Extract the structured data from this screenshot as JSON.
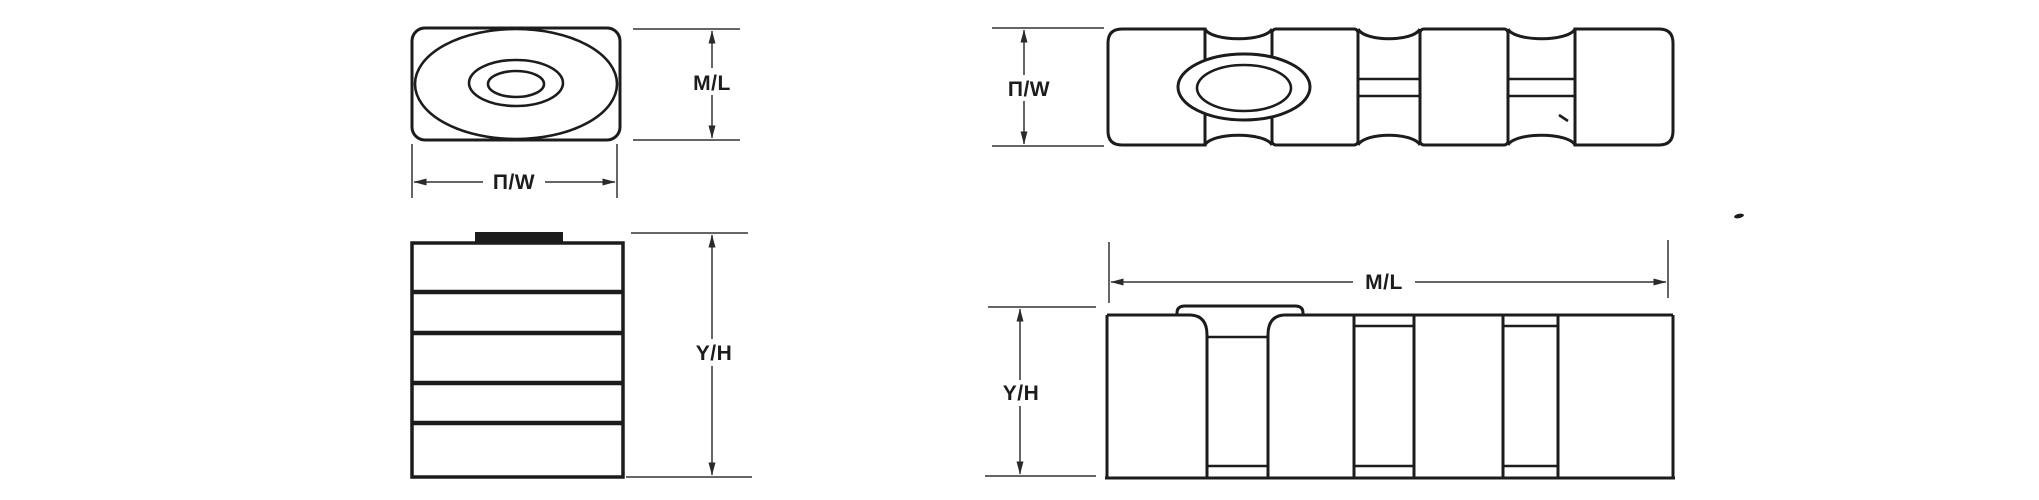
{
  "colors": {
    "background": "#ffffff",
    "ink": "#1c1c1c",
    "dimension_line": "#333333"
  },
  "figures": {
    "top_left_view": {
      "height_dim_label": "M/L",
      "width_dim_label": "П/W"
    },
    "top_right_view": {
      "height_dim_label": "П/W"
    },
    "bottom_left_view": {
      "height_dim_label": "Y/H"
    },
    "bottom_right_view": {
      "height_dim_label": "Y/H",
      "width_dim_label": "M/L"
    }
  }
}
